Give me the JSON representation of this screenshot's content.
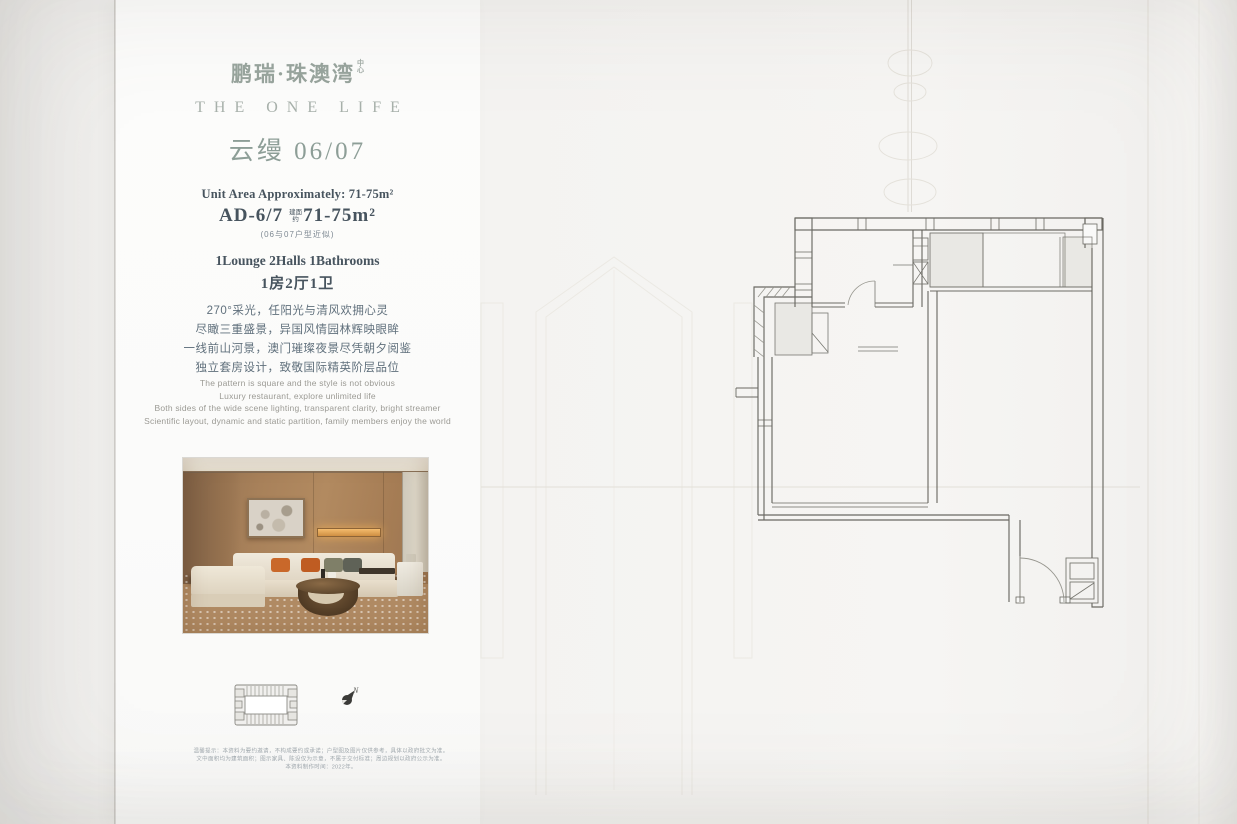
{
  "page": {
    "background_color": "#f4f3f1",
    "panel_color": "#fbfbfa",
    "accent_sage": "#8d9e97",
    "ink_dark": "#47545e",
    "plan_line_color": "#5f5e57",
    "plan_fill_color": "#e9e8e4"
  },
  "brand": {
    "logo_cn": "鹏瑞·珠澳湾",
    "logo_suffix": "中心",
    "logo_en": "THE ONE LIFE",
    "unit_title": "云缦 06/07"
  },
  "unit_info": {
    "area_en": "Unit Area Approximately: 71-75m²",
    "unit_code": "AD-6/7",
    "area_prefix": "建面约",
    "area_value": "71-75m²",
    "area_note": "(06与07户型近似)",
    "layout_en": "1Lounge 2Halls 1Bathrooms",
    "layout_cn": "1房2厅1卫"
  },
  "description_cn": [
    "270°采光，任阳光与清风欢拥心灵",
    "尽瞰三重盛景，异国风情园林辉映眼眸",
    "一线前山河景，澳门璀璨夜景尽凭朝夕阅鉴",
    "独立套房设计，致敬国际精英阶层品位"
  ],
  "description_en": [
    "The pattern is square and the style is not obvious",
    "Luxury restaurant, explore unlimited life",
    "Both sides of the wide scene lighting, transparent clarity, bright streamer",
    "Scientific layout, dynamic and static partition, family members enjoy the world"
  ],
  "disclaimer": [
    "温馨提示：本资料为要约邀请，不构成要约或承诺；户型图及图片仅供参考，具体以政府批文为准。",
    "文中面积均为建筑面积；图示家具、陈设仅为示意，不属于交付标准；周边规划以政府公示为准。",
    "本资料制作时间：2022年。"
  ],
  "keyplan": {
    "compass_label": "N"
  }
}
